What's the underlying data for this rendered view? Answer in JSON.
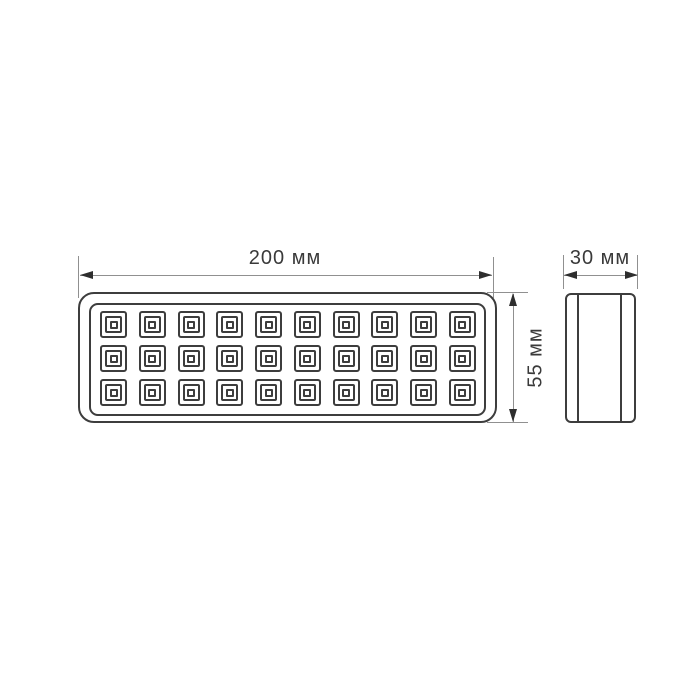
{
  "colors": {
    "background": "#ffffff",
    "outline": "#3d3d3d",
    "dimension_line": "#909090",
    "arrowhead": "#2e2e2e",
    "label_text": "#3a3a3a"
  },
  "front_view": {
    "name": "front view of LED light fixture",
    "width_label": "200 мм",
    "height_label": "55 мм",
    "led_grid": {
      "rows": 3,
      "columns": 10,
      "led_count": 30
    }
  },
  "side_view": {
    "name": "side view of LED light fixture",
    "depth_label": "30 мм"
  }
}
